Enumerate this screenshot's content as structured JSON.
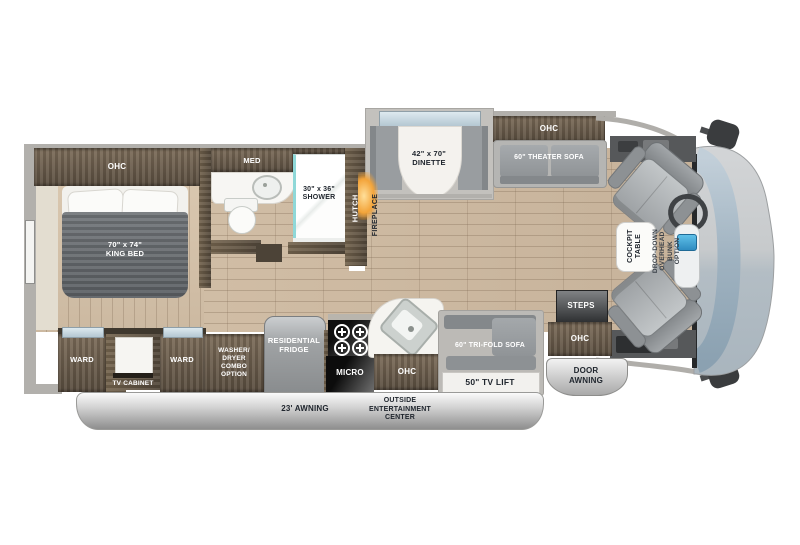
{
  "title": "Motorhome floor plan",
  "colors": {
    "cabinet_brown": "#6b5d4c",
    "floor_wood": "#ccb9a1",
    "fireplace_glow": "#f3a43a",
    "windshield_blue": "#9db0bf",
    "shell_gray": "#c7cacc",
    "label_light": "#ffffff",
    "label_dark": "#20262e"
  },
  "labels": {
    "bedroom_ohc": "OHC",
    "king_bed": "70\" x 74\"\nKING BED",
    "med": "MED",
    "shower": "30\" x 36\"\nSHOWER",
    "hutch": "HUTCH",
    "fireplace": "FIREPLACE",
    "dinette": "42\" x 70\"\nDINETTE",
    "sofa_ohc": "OHC",
    "theater_sofa": "60\" THEATER SOFA",
    "cockpit_table": "COCKPIT\nTABLE",
    "overhead_bunk": "DROP-DOWN\nOVERHEAD BUNK\nOPTION",
    "ward_left": "WARD",
    "tv_cabinet": "TV CABINET",
    "ward_right": "WARD",
    "washer_dryer": "WASHER/\nDRYER\nCOMBO\nOPTION",
    "fridge": "RESIDENTIAL\nFRIDGE",
    "micro": "MICRO",
    "kitchen_ohc": "OHC",
    "trifold_sofa": "60\" TRI-FOLD SOFA",
    "tv_lift": "50\" TV LIFT",
    "steps": "STEPS",
    "entry_ohc": "OHC",
    "door_awning": "DOOR\nAWNING",
    "awning": "23' AWNING",
    "outside_entertainment": "OUTSIDE\nENTERTAINMENT\nCENTER"
  }
}
